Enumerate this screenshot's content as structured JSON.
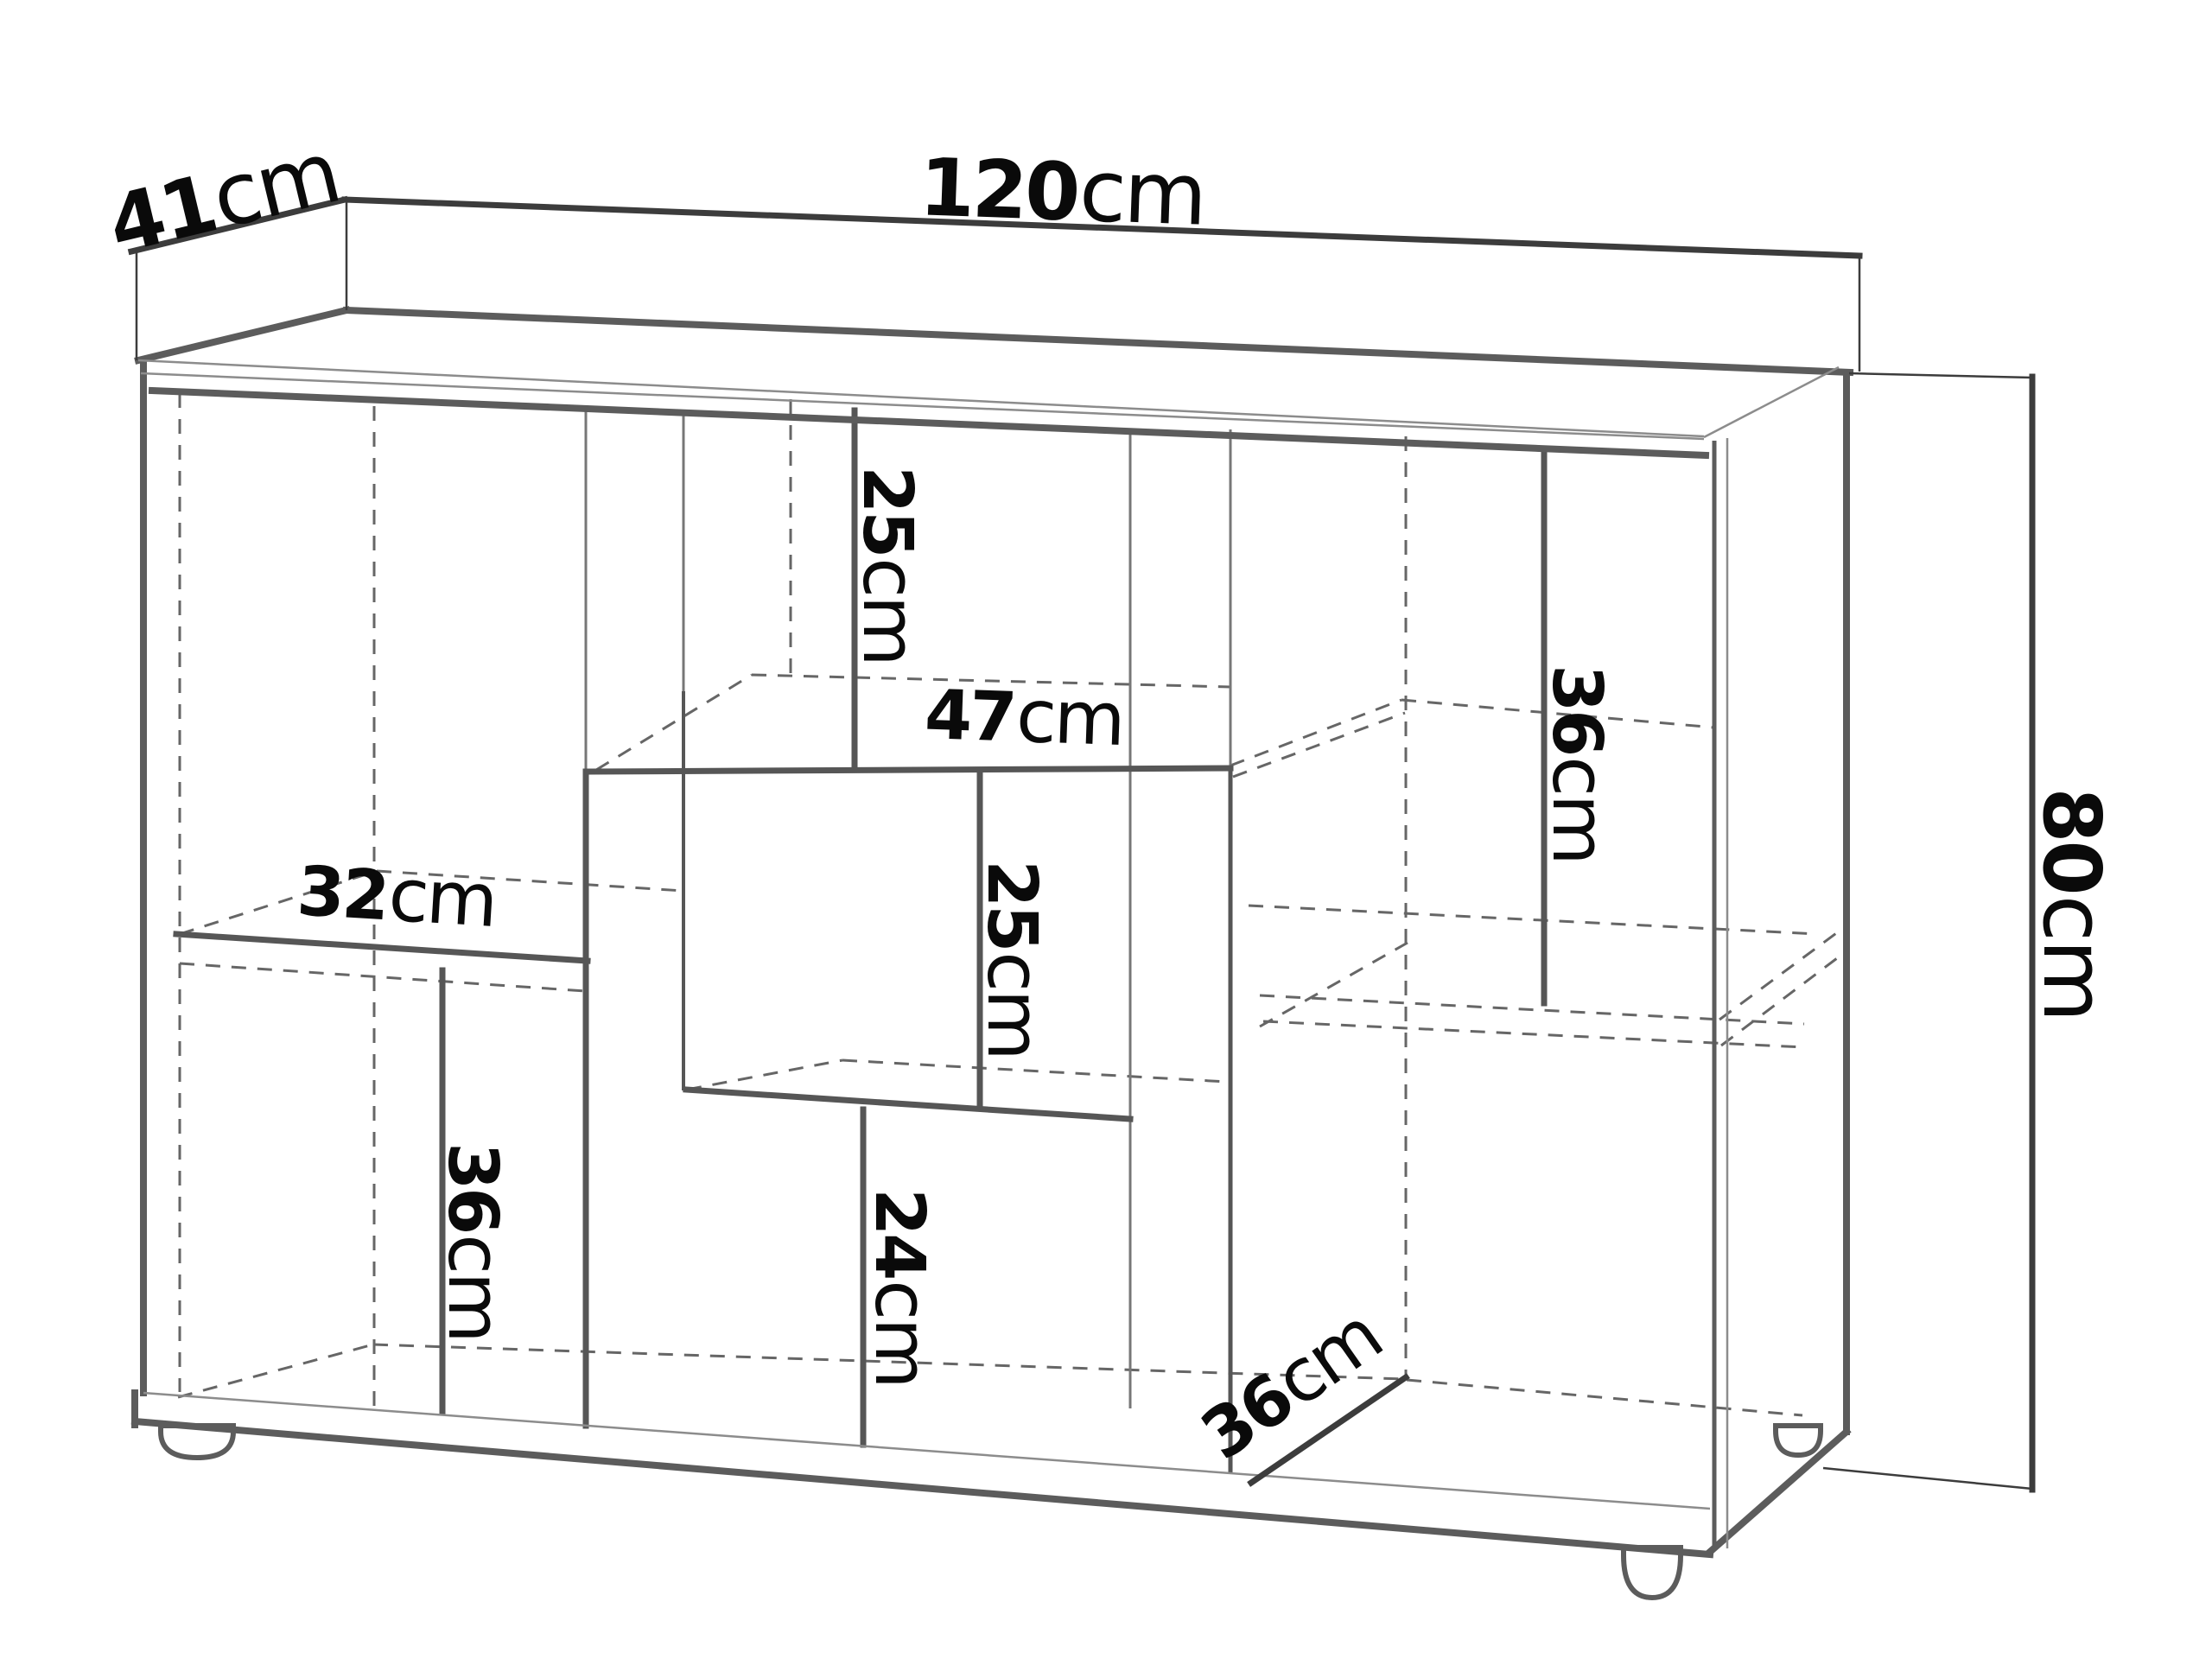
{
  "diagram": {
    "type": "furniture-dimension-drawing",
    "subject": "sideboard cabinet perspective view with open compartments",
    "units": "cm",
    "overall": {
      "width_cm": 120,
      "depth_cm": 41,
      "height_cm": 80
    },
    "labels": [
      {
        "id": "depth-overall",
        "value": "41",
        "unit": "cm"
      },
      {
        "id": "width-overall",
        "value": "120",
        "unit": "cm"
      },
      {
        "id": "height-overall",
        "value": "80",
        "unit": "cm"
      },
      {
        "id": "top-divider-height",
        "value": "25",
        "unit": "cm"
      },
      {
        "id": "top-shelf-width",
        "value": "47",
        "unit": "cm"
      },
      {
        "id": "middle-divider-height",
        "value": "25",
        "unit": "cm"
      },
      {
        "id": "left-shelf-width",
        "value": "32",
        "unit": "cm"
      },
      {
        "id": "left-divider-height",
        "value": "36",
        "unit": "cm"
      },
      {
        "id": "bottom-divider-height",
        "value": "24",
        "unit": "cm"
      },
      {
        "id": "right-divider-height",
        "value": "36",
        "unit": "cm"
      },
      {
        "id": "base-depth",
        "value": "36",
        "unit": "cm"
      }
    ],
    "colors": {
      "bg": "#ffffff",
      "dim": "#3c3c3c",
      "edge": "#5c5c5c",
      "interior": "#565656",
      "dashed": "#666666",
      "thin": "#8c8c8c",
      "text": "#0a0a0a"
    }
  }
}
